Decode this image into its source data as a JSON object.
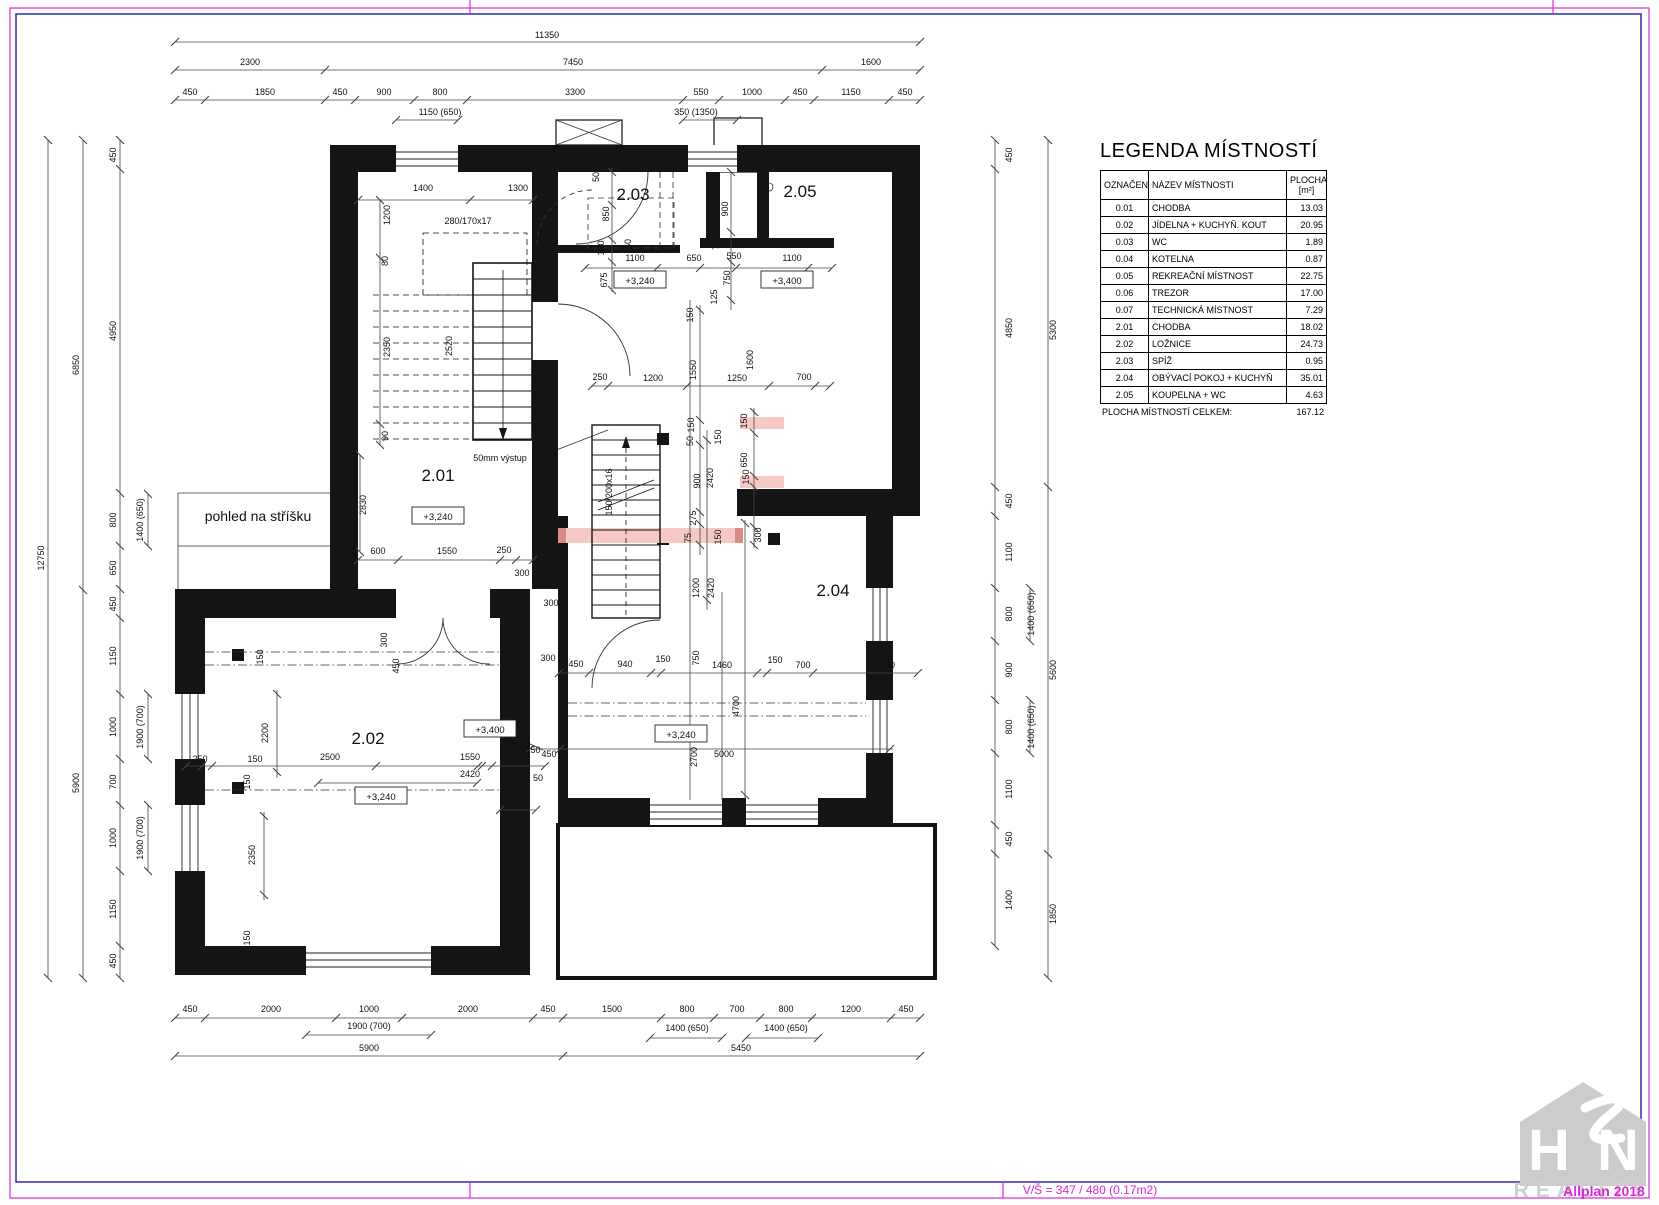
{
  "frame": {
    "scale_text": "V/Š = 347 / 480 (0.17m2)",
    "watermark": "Allplan 2018",
    "logo_letter_h": "H",
    "logo_letter_n": "N",
    "logo_word": "REALITY",
    "accent_magenta": "#d928d9",
    "accent_navy": "#2b2bb4"
  },
  "legend": {
    "title": "LEGENDA MÍSTNOSTÍ",
    "col_designation": "OZNAČENÍ",
    "col_name": "NÁZEV MÍSTNOSTI",
    "col_area": "PLOCHA",
    "col_area_unit": "[m²]",
    "rows": [
      [
        "0.01",
        "CHODBA",
        "13.03"
      ],
      [
        "0.02",
        "JÍDELNA + KUCHYŇ. KOUT",
        "20.95"
      ],
      [
        "0.03",
        "WC",
        "1.89"
      ],
      [
        "0.04",
        "KOTELNA",
        "0.87"
      ],
      [
        "0.05",
        "REKREAČNÍ MÍSTNOST",
        "22.75"
      ],
      [
        "0.06",
        "TREZOR",
        "17.00"
      ],
      [
        "0.07",
        "TECHNICKÁ MÍSTNOST",
        "7.29"
      ],
      [
        "2.01",
        "CHODBA",
        "18.02"
      ],
      [
        "2.02",
        "LOŽNICE",
        "24.73"
      ],
      [
        "2.03",
        "SPÍŽ",
        "0.95"
      ],
      [
        "2.04",
        "OBÝVACÍ POKOJ + KUCHYŇ",
        "35.01"
      ],
      [
        "2.05",
        "KOUPELNA + WC",
        "4.63"
      ]
    ],
    "total_label": "PLOCHA MÍSTNOSTÍ CELKEM:",
    "total_value": "167.12"
  },
  "plan": {
    "roof_note": "pohled na stříšku",
    "rooms": [
      [
        "2.01",
        438,
        481
      ],
      [
        "2.02",
        368,
        744
      ],
      [
        "2.03",
        633,
        200
      ],
      [
        "2.04",
        833,
        596
      ],
      [
        "2.05",
        800,
        197
      ]
    ],
    "elevations": [
      [
        "+3,240",
        438,
        516
      ],
      [
        "+3,240",
        640,
        280
      ],
      [
        "+3,240",
        381,
        796
      ],
      [
        "+3,240",
        681,
        734
      ],
      [
        "+3,400",
        787,
        280
      ],
      [
        "+3,400",
        490,
        729
      ]
    ],
    "labels": [
      [
        "11350",
        547,
        38,
        0
      ],
      [
        "2300",
        250,
        65,
        0
      ],
      [
        "7450",
        573,
        65,
        0
      ],
      [
        "1600",
        871,
        65,
        0
      ],
      [
        "450",
        190,
        95,
        0
      ],
      [
        "1850",
        265,
        95,
        0
      ],
      [
        "450",
        340,
        95,
        0
      ],
      [
        "900",
        384,
        95,
        0
      ],
      [
        "800",
        440,
        95,
        0
      ],
      [
        "3300",
        575,
        95,
        0
      ],
      [
        "550",
        701,
        95,
        0
      ],
      [
        "1000",
        752,
        95,
        0
      ],
      [
        "450",
        800,
        95,
        0
      ],
      [
        "1150",
        851,
        95,
        0
      ],
      [
        "450",
        905,
        95,
        0
      ],
      [
        "1150 (650)",
        440,
        115,
        0
      ],
      [
        "350 (1350)",
        696,
        115,
        0
      ],
      [
        "12750",
        44,
        558,
        1
      ],
      [
        "6850",
        79,
        365,
        1
      ],
      [
        "5900",
        79,
        783,
        1
      ],
      [
        "450",
        116,
        155,
        1
      ],
      [
        "4950",
        116,
        331,
        1
      ],
      [
        "800",
        116,
        520,
        1
      ],
      [
        "650",
        116,
        568,
        1
      ],
      [
        "450",
        116,
        604,
        1
      ],
      [
        "1150",
        116,
        656,
        1
      ],
      [
        "1000",
        116,
        727,
        1
      ],
      [
        "700",
        116,
        782,
        1
      ],
      [
        "1000",
        116,
        838,
        1
      ],
      [
        "1150",
        116,
        909,
        1
      ],
      [
        "450",
        116,
        961,
        1
      ],
      [
        "1400 (650)",
        143,
        520,
        1
      ],
      [
        "1900 (700)",
        143,
        727,
        1
      ],
      [
        "1900 (700)",
        143,
        838,
        1
      ],
      [
        "450",
        1012,
        155,
        1
      ],
      [
        "4850",
        1012,
        328,
        1
      ],
      [
        "450",
        1012,
        501,
        1
      ],
      [
        "1100",
        1012,
        552,
        1
      ],
      [
        "800",
        1012,
        614,
        1
      ],
      [
        "900",
        1012,
        670,
        1
      ],
      [
        "800",
        1012,
        727,
        1
      ],
      [
        "1100",
        1012,
        789,
        1
      ],
      [
        "450",
        1012,
        839,
        1
      ],
      [
        "1400",
        1012,
        900,
        1
      ],
      [
        "1400 (650)",
        1034,
        614,
        1
      ],
      [
        "1400 (650)",
        1034,
        727,
        1
      ],
      [
        "5300",
        1056,
        330,
        1
      ],
      [
        "5600",
        1056,
        670,
        1
      ],
      [
        "1850",
        1056,
        914,
        1
      ],
      [
        "450",
        190,
        1012,
        0
      ],
      [
        "2000",
        271,
        1012,
        0
      ],
      [
        "1000",
        369,
        1012,
        0
      ],
      [
        "2000",
        468,
        1012,
        0
      ],
      [
        "450",
        548,
        1012,
        0
      ],
      [
        "1500",
        612,
        1012,
        0
      ],
      [
        "800",
        687,
        1012,
        0
      ],
      [
        "700",
        737,
        1012,
        0
      ],
      [
        "800",
        786,
        1012,
        0
      ],
      [
        "1200",
        851,
        1012,
        0
      ],
      [
        "450",
        906,
        1012,
        0
      ],
      [
        "1900 (700)",
        369,
        1029,
        0
      ],
      [
        "1400 (650)",
        687,
        1031,
        0
      ],
      [
        "1400 (650)",
        786,
        1031,
        0
      ],
      [
        "5900",
        369,
        1051,
        0
      ],
      [
        "5450",
        741,
        1051,
        0
      ],
      [
        "1400",
        423,
        191,
        0
      ],
      [
        "1300",
        518,
        191,
        0
      ],
      [
        "280/170x17",
        468,
        224,
        0
      ],
      [
        "1200",
        390,
        215,
        1
      ],
      [
        "80",
        388,
        261,
        1
      ],
      [
        "2350",
        390,
        347,
        1
      ],
      [
        "2520",
        452,
        346,
        1
      ],
      [
        "90",
        388,
        436,
        1
      ],
      [
        "2830",
        366,
        505,
        1
      ],
      [
        "50mm výstup",
        500,
        461,
        0
      ],
      [
        "600",
        378,
        554,
        0
      ],
      [
        "1550",
        447,
        554,
        0
      ],
      [
        "250",
        504,
        553,
        0
      ],
      [
        "300",
        522,
        576,
        0
      ],
      [
        "300",
        551,
        606,
        0
      ],
      [
        "300",
        548,
        661,
        0
      ],
      [
        "300",
        387,
        640,
        1
      ],
      [
        "450",
        399,
        666,
        1
      ],
      [
        "50",
        599,
        177,
        1
      ],
      [
        "850",
        609,
        214,
        1
      ],
      [
        "100",
        604,
        248,
        1
      ],
      [
        "50",
        631,
        244,
        1
      ],
      [
        "1100",
        635,
        261,
        0
      ],
      [
        "650",
        694,
        261,
        0
      ],
      [
        "550",
        734,
        259,
        0
      ],
      [
        "1100",
        792,
        261,
        0
      ],
      [
        "675",
        607,
        280,
        1
      ],
      [
        "75",
        719,
        245,
        1
      ],
      [
        "900",
        728,
        209,
        1
      ],
      [
        "750",
        730,
        278,
        1
      ],
      [
        "125",
        717,
        297,
        1
      ],
      [
        "150",
        693,
        315,
        1
      ],
      [
        "1550",
        696,
        370,
        1
      ],
      [
        "1600",
        753,
        360,
        1
      ],
      [
        "250",
        600,
        380,
        0
      ],
      [
        "1200",
        653,
        381,
        0
      ],
      [
        "1250",
        737,
        381,
        0
      ],
      [
        "700",
        804,
        380,
        0
      ],
      [
        "150",
        747,
        421,
        1
      ],
      [
        "150",
        694,
        425,
        1
      ],
      [
        "50",
        693,
        441,
        1
      ],
      [
        "150",
        721,
        437,
        1
      ],
      [
        "650",
        747,
        460,
        1
      ],
      [
        "900",
        700,
        481,
        1
      ],
      [
        "2420",
        713,
        478,
        1
      ],
      [
        "150",
        749,
        477,
        1
      ],
      [
        "600",
        753,
        502,
        1
      ],
      [
        "275",
        696,
        518,
        1
      ],
      [
        "75",
        691,
        538,
        1
      ],
      [
        "150",
        721,
        537,
        1
      ],
      [
        "300",
        761,
        535,
        1
      ],
      [
        "150/200x16",
        612,
        492,
        1
      ],
      [
        "1200",
        699,
        588,
        1
      ],
      [
        "2420",
        714,
        588,
        1
      ],
      [
        "450",
        576,
        667,
        0
      ],
      [
        "940",
        625,
        667,
        0
      ],
      [
        "150",
        663,
        662,
        0
      ],
      [
        "750",
        699,
        658,
        1
      ],
      [
        "1460",
        722,
        668,
        0
      ],
      [
        "150",
        775,
        663,
        0
      ],
      [
        "700",
        803,
        668,
        0
      ],
      [
        "1600",
        885,
        668,
        0
      ],
      [
        "4700",
        739,
        706,
        1
      ],
      [
        "2700",
        697,
        757,
        1
      ],
      [
        "450",
        549,
        757,
        0
      ],
      [
        "5000",
        724,
        757,
        0
      ],
      [
        "550",
        513,
        806,
        0
      ],
      [
        "250",
        200,
        762,
        0
      ],
      [
        "150",
        255,
        762,
        0
      ],
      [
        "2500",
        330,
        760,
        0
      ],
      [
        "1550",
        470,
        760,
        0
      ],
      [
        "50",
        513,
        760,
        0
      ],
      [
        "150",
        533,
        753,
        0
      ],
      [
        "2420",
        470,
        777,
        0
      ],
      [
        "50",
        538,
        781,
        0
      ],
      [
        "150",
        263,
        657,
        1
      ],
      [
        "2200",
        268,
        733,
        1
      ],
      [
        "2350",
        255,
        855,
        1
      ],
      [
        "150",
        250,
        782,
        1
      ],
      [
        "150",
        250,
        938,
        1
      ]
    ],
    "chains": [
      [
        "h",
        42,
        175,
        920,
        [
          175,
          920
        ]
      ],
      [
        "h",
        70,
        175,
        920,
        [
          175,
          325,
          822,
          920
        ]
      ],
      [
        "h",
        100,
        175,
        920,
        [
          175,
          205,
          325,
          355,
          414,
          467,
          683,
          719,
          785,
          814,
          889,
          920
        ]
      ],
      [
        "h",
        120,
        396,
        458,
        [
          396,
          458
        ]
      ],
      [
        "h",
        120,
        683,
        737,
        [
          683,
          737
        ]
      ],
      [
        "h",
        200,
        358,
        533,
        [
          358,
          470,
          533
        ]
      ],
      [
        "h",
        268,
        585,
        832,
        [
          585,
          657,
          700,
          736,
          808,
          832
        ]
      ],
      [
        "h",
        386,
        592,
        830,
        [
          592,
          608,
          687,
          769,
          815,
          830
        ]
      ],
      [
        "h",
        560,
        358,
        533,
        [
          358,
          398,
          500,
          516,
          533
        ]
      ],
      [
        "h",
        673,
        558,
        918,
        [
          559,
          589,
          651,
          661,
          757,
          767,
          813,
          918
        ]
      ],
      [
        "h",
        766,
        186,
        545,
        [
          186,
          202,
          212,
          376,
          478,
          482,
          492,
          545
        ]
      ],
      [
        "h",
        783,
        318,
        477,
        [
          318,
          477
        ]
      ],
      [
        "h",
        749,
        530,
        893,
        [
          530,
          560,
          890
        ]
      ],
      [
        "h",
        810,
        500,
        536,
        [
          500,
          536
        ]
      ],
      [
        "h",
        1018,
        175,
        920,
        [
          175,
          205,
          336,
          402,
          533,
          563,
          661,
          714,
          760,
          812,
          891,
          920
        ]
      ],
      [
        "h",
        1035,
        306,
        431,
        [
          306,
          431
        ]
      ],
      [
        "h",
        1038,
        650,
        722,
        [
          650,
          722
        ]
      ],
      [
        "h",
        1038,
        746,
        818,
        [
          746,
          818
        ]
      ],
      [
        "h",
        1056,
        175,
        920,
        [
          175,
          563,
          920
        ]
      ],
      [
        "v",
        48,
        140,
        978,
        [
          140,
          978
        ]
      ],
      [
        "v",
        83,
        140,
        978,
        [
          140,
          590,
          978
        ]
      ],
      [
        "v",
        120,
        140,
        978,
        [
          140,
          169,
          493,
          546,
          589,
          618,
          694,
          759,
          805,
          871,
          946,
          978
        ]
      ],
      [
        "v",
        148,
        494,
        546,
        [
          494,
          546
        ]
      ],
      [
        "v",
        148,
        694,
        759,
        [
          694,
          759
        ]
      ],
      [
        "v",
        148,
        805,
        871,
        [
          805,
          871
        ]
      ],
      [
        "v",
        995,
        140,
        946,
        [
          140,
          169,
          487,
          516,
          588,
          641,
          700,
          753,
          825,
          854,
          946
        ]
      ],
      [
        "v",
        1030,
        588,
        641,
        [
          588,
          641
        ]
      ],
      [
        "v",
        1030,
        700,
        753,
        [
          700,
          753
        ]
      ],
      [
        "v",
        1048,
        140,
        978,
        [
          140,
          487,
          854,
          978
        ]
      ],
      [
        "v",
        380,
        200,
        445,
        [
          200,
          258,
          424,
          445
        ]
      ],
      [
        "v",
        360,
        455,
        552,
        [
          455,
          552
        ]
      ],
      [
        "v",
        612,
        168,
        292,
        [
          172,
          205,
          240,
          262,
          290
        ]
      ],
      [
        "v",
        731,
        172,
        310,
        [
          172,
          232,
          262,
          300
        ]
      ],
      [
        "v",
        700,
        305,
        555,
        [
          310,
          420,
          445,
          512,
          524,
          545
        ]
      ],
      [
        "v",
        754,
        408,
        548,
        [
          412,
          433,
          476,
          487,
          527,
          545
        ]
      ],
      [
        "v",
        707,
        430,
        610,
        [
          440,
          600
        ]
      ],
      [
        "v",
        745,
        520,
        798,
        [
          523,
          795
        ]
      ],
      [
        "v",
        277,
        690,
        778,
        [
          694,
          772
        ]
      ],
      [
        "v",
        264,
        812,
        900,
        [
          816,
          895
        ]
      ],
      [
        "v",
        690,
        300,
        800,
        []
      ],
      [
        "v",
        722,
        592,
        800,
        []
      ]
    ]
  }
}
